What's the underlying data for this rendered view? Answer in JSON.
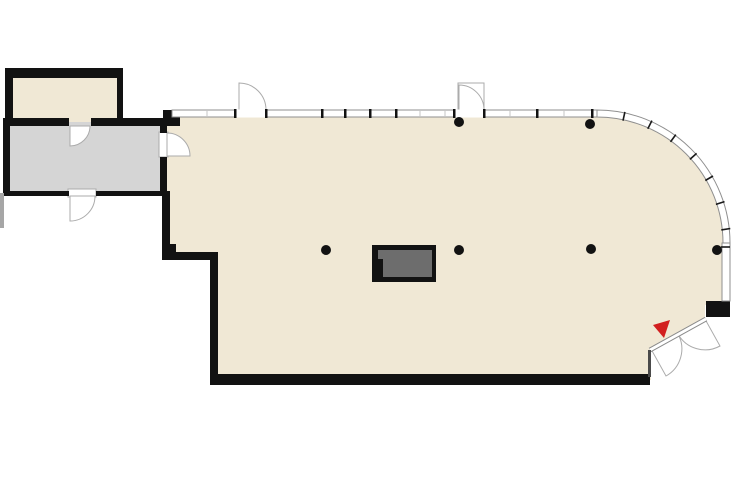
{
  "plan": {
    "background": "#ffffff",
    "colors": {
      "floor": "#f0e8d5",
      "annex_floor": "#d5d5d5",
      "wall": "#121212",
      "window_frame": "#8f8f8f",
      "door_arc": "#ababab",
      "fixture": "#6d6d6d",
      "fixture_border": "#121212",
      "marker": "#d21f1f",
      "edge_stub": "#a6a6a6"
    },
    "columns": [
      {
        "x": 459,
        "y": 122
      },
      {
        "x": 590,
        "y": 124
      },
      {
        "x": 326,
        "y": 250
      },
      {
        "x": 459,
        "y": 250
      },
      {
        "x": 591,
        "y": 249
      },
      {
        "x": 717,
        "y": 250
      }
    ],
    "column_radius": "5",
    "marker": {
      "points": "653,325 670,320 664,338"
    }
  }
}
